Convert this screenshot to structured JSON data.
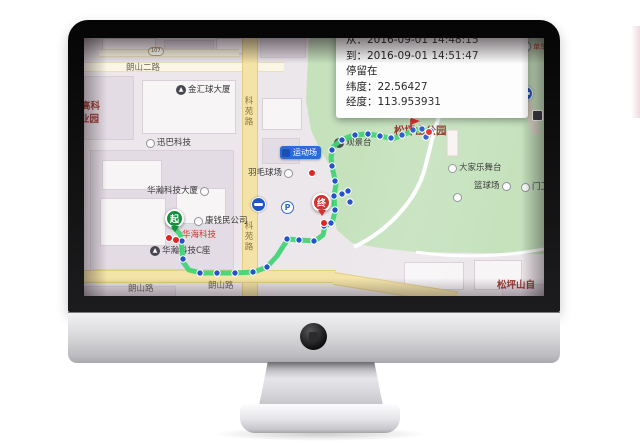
{
  "popup": {
    "from": "从：2016-09-01 14:48:15",
    "to": "到：2016-09-01 14:51:47",
    "stay": "停留在",
    "lat": "纬度：22.56427",
    "lng": "经度：113.953931"
  },
  "map": {
    "road_badge": "107",
    "roads": {
      "langshan2": "朗山二路",
      "keyuan": "科苑路",
      "langshan": "朗山路"
    },
    "pois": {
      "jinhuiqiu_tower": "金汇球大厦",
      "xunba_tech": "迅巴科技",
      "huahan_tower": "华瀚科技大厦",
      "kangqian_co": "康钱民公司",
      "huahai_tech": "华海科技",
      "huahan_c": "华瀚科技C座",
      "badminton_court": "羽毛球场",
      "selected_spot": "运动场",
      "viewing_platform": "观景台",
      "park_name": "松坪山公园",
      "stage": "大家乐舞台",
      "basketball_court": "篮球场",
      "gate": "门卫",
      "bike_share": "单车",
      "park_name_partial": "松坪山自",
      "tech_park_line1": "高科",
      "tech_park_line2": "业园"
    },
    "markers": {
      "start": "起",
      "end": "终"
    },
    "colors": {
      "route": "#3fd473",
      "waypoint": "#2653c9",
      "stay_point": "#e02525",
      "park": "#c5e2bd"
    }
  }
}
